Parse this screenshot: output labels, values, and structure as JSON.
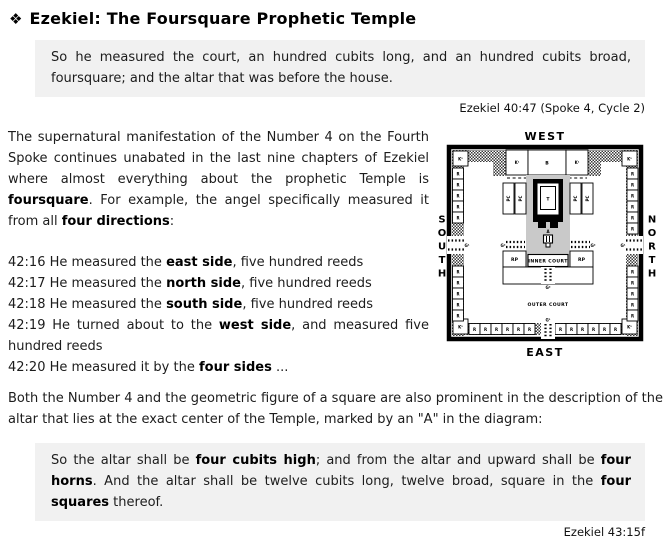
{
  "header": {
    "icon": "❖",
    "title": "Ezekiel: The Foursquare Prophetic Temple"
  },
  "quote1": {
    "text": "So he measured the court, an hundred cubits long, and an hundred cubits broad, foursquare; and the altar that was before the house.",
    "citation": "Ezekiel 40:47 (Spoke 4, Cycle 2)"
  },
  "intro": {
    "segments": [
      "The supernatural manifestation of the Number 4 on the Fourth Spoke continues unabated in the last nine chapters of Ezekiel where almost everything about the prophetic Temple is ",
      "foursquare",
      ". For example, the angel specifically measured it from all ",
      "four directions",
      ":"
    ]
  },
  "verses": [
    {
      "pre": "42:16 He measured the ",
      "bold": "east side",
      "post": ", five hundred reeds"
    },
    {
      "pre": "42:17 He measured the ",
      "bold": "north side",
      "post": ", five hundred reeds"
    },
    {
      "pre": "42:18 He measured the ",
      "bold": "south side",
      "post": ", five hundred reeds"
    },
    {
      "pre": "42:19 He turned about to the ",
      "bold": "west side",
      "post": ", and measured five hundred reeds"
    },
    {
      "pre": "42:20 He measured it by the ",
      "bold": "four sides",
      "post": " ..."
    }
  ],
  "altar_paragraph": "Both the Number 4 and the geometric figure of a square are also prominent in the description of the altar that lies at the exact center of the Temple, marked by an \"A\" in the diagram:",
  "quote2": {
    "segments": [
      "So the altar shall be ",
      "four cubits high",
      "; and from the altar and upward shall be ",
      "four horns",
      ". And the altar shall be twelve cubits long, twelve broad, square in the ",
      "four squares",
      " thereof."
    ],
    "citation": "Ezekiel 43:15f"
  },
  "diagram": {
    "west": "WEST",
    "east": "EAST",
    "south": "SOUTH",
    "north": "NORTH",
    "inner_court": "INNER COURT",
    "outer_court": "OUTER COURT",
    "room_r": "R",
    "room_k": "K¹",
    "building_b": "B",
    "room_rp": "RP",
    "room_pc": "PC",
    "temple_t": "T",
    "altar_a": "A",
    "gate_outer": "G¹",
    "gate_inner": "G²",
    "colors": {
      "inner_court_gray": "#c9c9c9",
      "quote_background": "#f1f1f1"
    }
  }
}
